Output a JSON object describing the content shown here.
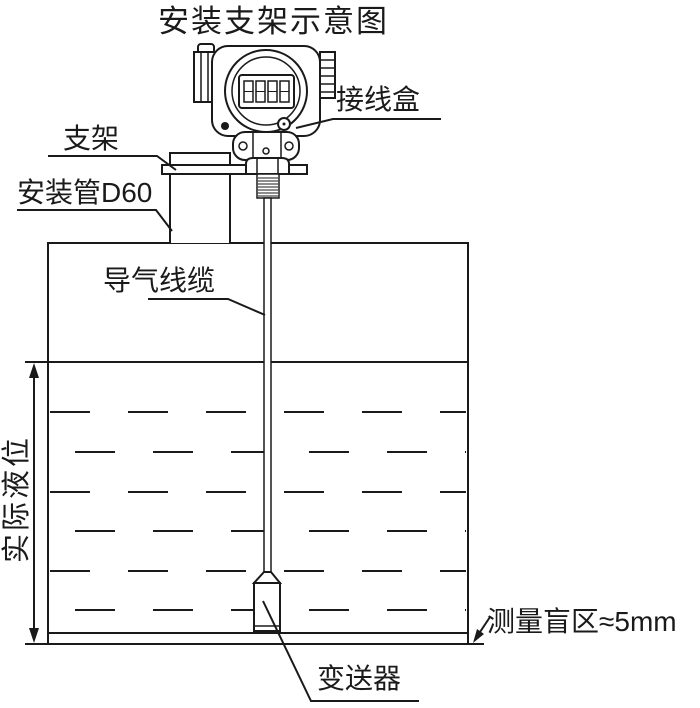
{
  "title": "安装支架示意图",
  "labels": {
    "junction_box": "接线盒",
    "bracket": "支架",
    "mounting_pipe": "安装管D60",
    "air_cable": "导气线缆",
    "actual_level": "实际液位",
    "blind_zone": "测量盲区≈5mm",
    "transmitter": "变送器"
  },
  "colors": {
    "line": "#1a1a1a",
    "background": "#ffffff"
  }
}
